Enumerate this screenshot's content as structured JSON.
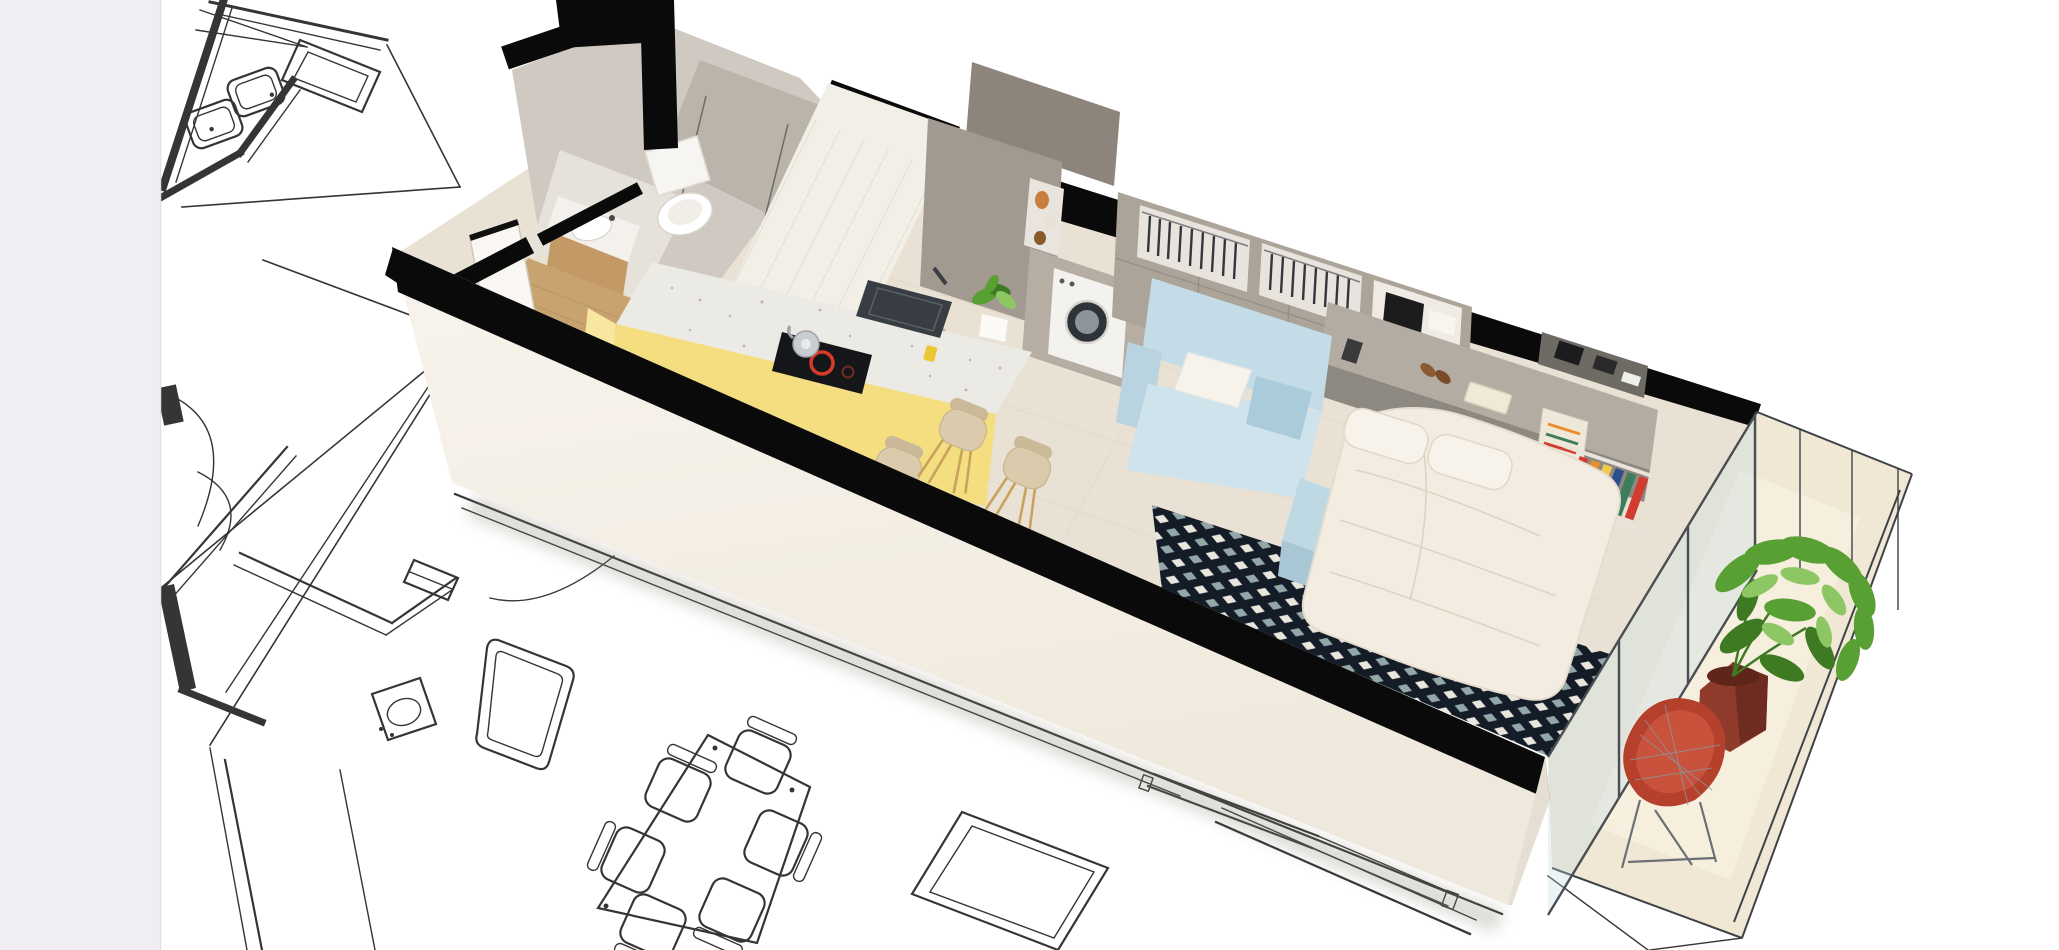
{
  "app": {
    "type": "image-canvas-with-pasteboard",
    "pasteboard": {
      "present": true,
      "side": "left",
      "width_px": 160
    }
  },
  "scene": {
    "kind": "3d-cutaway-floor-plan-render",
    "view": "isometric-from-above",
    "overlay": "2d-architectural-blueprint-line-drawing",
    "rooms": [
      {
        "name": "bathroom",
        "items": [
          "toilet",
          "concrete-shower",
          "vanity-sink",
          "wood-vanity-cabinet",
          "white-entry-door",
          "wood-entry-floor",
          "white-tile-wall"
        ]
      },
      {
        "name": "kitchen",
        "items": [
          "terrazzo-island-counter",
          "yellow-island-base",
          "inset-sink",
          "induction-hob-red-ring",
          "silver-kettle",
          "yellow-cup",
          "island-plant-white-pot",
          "three-beige-bar-stools",
          "tall-taupe-cabinets",
          "open-shelf-with-vases",
          "integrated-washing-machine"
        ]
      },
      {
        "name": "living-bedroom",
        "items": [
          "wardrobe-with-hanging-clothes",
          "open-storage-cube-with-box-and-towel",
          "light-blue-sofa",
          "white-sofa-pillow",
          "double-bed-white-duvet",
          "two-white-pillows",
          "light-blue-bed-bench",
          "gray-headboard-shelf",
          "book-on-shelf",
          "brown-shoes",
          "geometric-cube-pattern-rug",
          "wall-shelf-with-colorful-books",
          "colorful-poster",
          "dark-wall-shelf-with-boxes"
        ]
      },
      {
        "name": "balcony",
        "items": [
          "glass-partition",
          "metal-railing",
          "dieffenbachia-plant",
          "dark-red-hex-planter",
          "red-wire-diamond-chair"
        ]
      }
    ],
    "blueprint_elements": [
      "bathroom-plan-with-twin-sinks",
      "shower-plan-rectangle",
      "projection-leader-lines",
      "door-swing-arcs",
      "corridor-double-walls",
      "stair-void-wedge",
      "toilet-plan",
      "bathtub-plan",
      "dining-table-with-six-chairs",
      "room-outline-rectangle",
      "window-sill-lines",
      "balcony-railing-line-art"
    ]
  },
  "colors": {
    "pasteboard": "#EFEFF3",
    "pasteboard_border": "#E0E0E6",
    "canvas": "#FFFFFF",
    "blueprint_line": "#1F1F1F",
    "wall_cut": "#0A0A0A",
    "front_wall": "#F6F1E9",
    "gable_wall": "#F3EEE6",
    "back_wall": "#D8D2C9",
    "concrete": "#CFC9C1",
    "concrete_dark": "#BBB4AB",
    "tile_wall": "#F2EFE7",
    "floor": "#E9E1D3",
    "bathroom_floor": "#E6E2DA",
    "entry_wood": "#C9A36F",
    "wood_cabinet": "#C39A66",
    "counter": "#ECEAE5",
    "counter_speck": "#B9B5AE",
    "island_yellow": "#F4DE80",
    "island_yellow_light": "#F8E79E",
    "sink_dark": "#383D43",
    "hob_dark": "#15161A",
    "hob_ring": "#D83A28",
    "kettle": "#C9CDD2",
    "cup_yellow": "#E9C832",
    "cabinet": "#A29990",
    "cabinet_dark": "#8D847B",
    "cabinet_light": "#B6ADA3",
    "washer": "#F4F2EE",
    "washer_door": "#2E3338",
    "washer_drum": "#8C959C",
    "wardrobe": "#ACA399",
    "niche": "#E8E4DD",
    "clothes": "#34363B",
    "sofa": "#C3DCE7",
    "sofa_light": "#CFE3EC",
    "sofa_dark": "#B9D4E0",
    "pillow": "#F8F3EA",
    "bed": "#F3ECE1",
    "bed_shade": "#E3D8C9",
    "bench": "#BFD9E4",
    "bench_dark": "#A9C6D4",
    "headboard": "#B3ACA3",
    "headboard_ledge": "#8D8880",
    "shelf_dark": "#6E6A64",
    "rug_navy": "#141C28",
    "rug_white": "#E9E6DD",
    "rug_slate": "#93A7A9",
    "book_red": "#D23B2F",
    "book_orange": "#E98E2B",
    "book_yellow": "#F2C94C",
    "book_green": "#3E7D5C",
    "book_blue": "#2B4E8C",
    "poster": "#EFE8D8",
    "balcony_floor": "#F0E8D5",
    "glass": "rgba(190,215,228,0.30)",
    "frame_dark": "#3F4347",
    "plant_dark": "#3D7A22",
    "plant_mid": "#58A033",
    "plant_light": "#8CC763",
    "planter": "#8E3B2B",
    "planter_dark": "#6E2C20",
    "chair_red": "#B5402C",
    "chair_red_light": "#C8523B",
    "wire": "#8E9398",
    "stool": "#DBCBAC",
    "stool_leg": "#C9A25C",
    "shadow": "#8A8376"
  }
}
